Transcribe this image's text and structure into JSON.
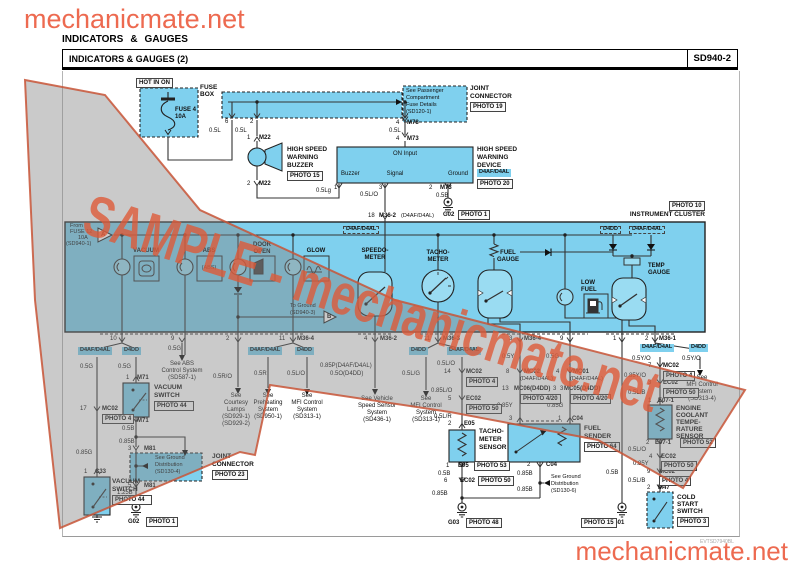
{
  "page": {
    "logo_top": "mechanicmate.net",
    "logo_bottom": "mechanicmate.net",
    "section_title": [
      "INDICATORS",
      "&",
      "GAUGES"
    ],
    "diagram_title": "INDICATORS & GAUGES (2)",
    "diagram_code": "SD940-2",
    "doc_code": "EVTSD7940BL",
    "watermark": "SAMPLE - mechanicmate.net"
  },
  "colors": {
    "accent_orange": "#ed6a50",
    "component_blue": "#7fd0ee",
    "watermark_gray": "rgba(128,128,128,0.42)",
    "watermark_orange": "#dd5a38",
    "wire": "#333333"
  },
  "texts": [
    [
      "FUSE 4",
      175,
      107,
      "xb"
    ],
    [
      "10A",
      175,
      114,
      "xb"
    ],
    [
      "FUSE",
      200,
      85,
      "sb"
    ],
    [
      "BOX",
      200,
      92,
      "sb"
    ],
    [
      "6",
      225,
      119,
      "x"
    ],
    [
      "2",
      250,
      119,
      "x"
    ],
    [
      "0.5L",
      209,
      128,
      "x"
    ],
    [
      "0.5L",
      235,
      128,
      "x"
    ],
    [
      "1",
      247,
      135,
      "x"
    ],
    [
      "M22",
      259,
      135,
      "xb"
    ],
    [
      "2",
      247,
      181,
      "x"
    ],
    [
      "M22",
      259,
      181,
      "xb"
    ],
    [
      "HIGH SPEED",
      287,
      147,
      "sb"
    ],
    [
      "WARNING",
      287,
      155,
      "sb"
    ],
    [
      "BUZZER",
      287,
      163,
      "sb"
    ],
    [
      "0.5Lg",
      316,
      188,
      "x"
    ],
    [
      "4",
      396,
      120,
      "x"
    ],
    [
      "M78",
      407,
      120,
      "xb"
    ],
    [
      "0.5L",
      389,
      128,
      "x"
    ],
    [
      "4",
      396,
      136,
      "x"
    ],
    [
      "M73",
      407,
      136,
      "xb"
    ],
    [
      "JOINT",
      470,
      86,
      "sb"
    ],
    [
      "CONNECTOR",
      470,
      94,
      "sb"
    ],
    [
      "See Passenger",
      406,
      89,
      "t"
    ],
    [
      "Compartment",
      406,
      96,
      "t"
    ],
    [
      "Fuse Details",
      406,
      103,
      "t"
    ],
    [
      "(SD120-1)",
      406,
      110,
      "t"
    ],
    [
      "ON Input",
      405,
      151,
      "x",
      "c"
    ],
    [
      "Buzzer",
      341,
      171,
      "x"
    ],
    [
      "Signal",
      395,
      171,
      "x",
      "c"
    ],
    [
      "Ground",
      468,
      171,
      "x",
      "r"
    ],
    [
      "1",
      334,
      185,
      "x"
    ],
    [
      "3",
      379,
      185,
      "x"
    ],
    [
      "0.5L/O",
      360,
      192,
      "x"
    ],
    [
      "2",
      429,
      185,
      "x"
    ],
    [
      "M73",
      440,
      185,
      "xb"
    ],
    [
      "0.5B",
      436,
      193,
      "x"
    ],
    [
      "HIGH SPEED",
      477,
      147,
      "sb"
    ],
    [
      "WARNING",
      477,
      155,
      "sb"
    ],
    [
      "DEVICE",
      477,
      163,
      "sb"
    ],
    [
      "G02",
      443,
      212,
      "xb"
    ],
    [
      "18",
      368,
      213,
      "x"
    ],
    [
      "M36-2",
      379,
      213,
      "xb"
    ],
    [
      "(D4AF/D4AL)",
      401,
      214,
      "t"
    ],
    [
      "INSTRUMENT CLUSTER",
      705,
      212,
      "sb",
      "r"
    ],
    [
      "From",
      70,
      224,
      "t"
    ],
    [
      "FUSE 12",
      70,
      230,
      "t"
    ],
    [
      "10A",
      78,
      236,
      "t"
    ],
    [
      "(SD940-1)",
      66,
      242,
      "t"
    ],
    [
      "A",
      101,
      232,
      "xb"
    ],
    [
      "B",
      327,
      314,
      "xb"
    ],
    [
      "VACUUM",
      146,
      248,
      "xb",
      "c"
    ],
    [
      "ABS",
      209,
      248,
      "xb",
      "c"
    ],
    [
      "DOOR",
      262,
      242,
      "xb",
      "c"
    ],
    [
      "OPEN",
      262,
      249,
      "xb",
      "c"
    ],
    [
      "GLOW",
      316,
      248,
      "xb",
      "c"
    ],
    [
      "(ABS)",
      209,
      266,
      "t",
      "c"
    ],
    [
      "To Ground",
      290,
      304,
      "t"
    ],
    [
      "(SD940-3)",
      290,
      311,
      "t"
    ],
    [
      "SPEEDO-",
      375,
      248,
      "xb",
      "c"
    ],
    [
      "METER",
      375,
      255,
      "xb",
      "c"
    ],
    [
      "TACHO-",
      438,
      250,
      "xb",
      "c"
    ],
    [
      "METER",
      438,
      257,
      "xb",
      "c"
    ],
    [
      "FUEL",
      508,
      250,
      "xb",
      "c"
    ],
    [
      "GAUGE",
      508,
      257,
      "xb",
      "c"
    ],
    [
      "LOW",
      581,
      280,
      "xb"
    ],
    [
      "FUEL",
      581,
      287,
      "xb"
    ],
    [
      "TEMP",
      648,
      263,
      "xb"
    ],
    [
      "GAUGE",
      648,
      270,
      "xb"
    ],
    [
      "10",
      110,
      336,
      "x"
    ],
    [
      "9",
      171,
      336,
      "x"
    ],
    [
      "2",
      226,
      336,
      "x"
    ],
    [
      "11",
      279,
      336,
      "x"
    ],
    [
      "M36-4",
      297,
      336,
      "xb"
    ],
    [
      "4",
      364,
      336,
      "x"
    ],
    [
      "M36-2",
      380,
      336,
      "xb"
    ],
    [
      "11",
      424,
      336,
      "x"
    ],
    [
      "M36-3",
      443,
      336,
      "xb"
    ],
    [
      "3",
      509,
      336,
      "x"
    ],
    [
      "M36-4",
      524,
      336,
      "xb"
    ],
    [
      "9",
      560,
      336,
      "x"
    ],
    [
      "1",
      613,
      336,
      "x"
    ],
    [
      "2",
      645,
      336,
      "x"
    ],
    [
      "M36-1",
      659,
      336,
      "xb"
    ],
    [
      "0.5G",
      80,
      364,
      "x"
    ],
    [
      "17",
      80,
      406,
      "x"
    ],
    [
      "MC02",
      102,
      406,
      "xb"
    ],
    [
      "0.85G",
      76,
      450,
      "x"
    ],
    [
      "1",
      84,
      469,
      "x"
    ],
    [
      "C33",
      95,
      469,
      "xb"
    ],
    [
      "VACUUM",
      112,
      479,
      "sb"
    ],
    [
      "SWITCH",
      112,
      487,
      "sb"
    ],
    [
      "0.5G",
      118,
      364,
      "x"
    ],
    [
      "1",
      126,
      375,
      "x"
    ],
    [
      "M71",
      137,
      375,
      "xb"
    ],
    [
      "VACUUM",
      154,
      385,
      "sb"
    ],
    [
      "SWITCH",
      154,
      393,
      "sb"
    ],
    [
      "2",
      126,
      418,
      "x"
    ],
    [
      "M71",
      137,
      418,
      "xb"
    ],
    [
      "0.5B",
      122,
      426,
      "x"
    ],
    [
      "0.85B",
      119,
      439,
      "x"
    ],
    [
      "3",
      128,
      446,
      "x"
    ],
    [
      "M81",
      144,
      446,
      "xb"
    ],
    [
      "See Ground",
      155,
      456,
      "t"
    ],
    [
      "Distribution",
      155,
      463,
      "t"
    ],
    [
      "(SD130-4)",
      155,
      470,
      "t"
    ],
    [
      "JOINT",
      212,
      454,
      "sb"
    ],
    [
      "CONNECTOR",
      212,
      462,
      "sb"
    ],
    [
      "5",
      128,
      483,
      "x"
    ],
    [
      "M81",
      144,
      483,
      "xb"
    ],
    [
      "1.25B",
      117,
      490,
      "x"
    ],
    [
      "1.25B",
      117,
      498,
      "x"
    ],
    [
      "G02",
      128,
      519,
      "xb"
    ],
    [
      "0.5G",
      168,
      346,
      "x"
    ],
    [
      "See ABS",
      182,
      361,
      "x",
      "c"
    ],
    [
      "Control System",
      182,
      368,
      "x",
      "c"
    ],
    [
      "(SD587-1)",
      182,
      375,
      "x",
      "c"
    ],
    [
      "0.5R/O",
      213,
      374,
      "x"
    ],
    [
      "See",
      236,
      393,
      "x",
      "c"
    ],
    [
      "Courtesy",
      236,
      400,
      "x",
      "c"
    ],
    [
      "Lamps",
      236,
      407,
      "x",
      "c"
    ],
    [
      "(SD929-1)",
      236,
      414,
      "x",
      "c"
    ],
    [
      "(SD929-2)",
      236,
      421,
      "x",
      "c"
    ],
    [
      "0.5R",
      254,
      371,
      "x"
    ],
    [
      "See",
      268,
      393,
      "x",
      "c"
    ],
    [
      "Preheating",
      268,
      400,
      "x",
      "c"
    ],
    [
      "System",
      268,
      407,
      "x",
      "c"
    ],
    [
      "(SD950-1)",
      268,
      414,
      "x",
      "c"
    ],
    [
      "0.5L/O",
      287,
      371,
      "x"
    ],
    [
      "See",
      307,
      393,
      "x",
      "c"
    ],
    [
      "MFI Control",
      307,
      400,
      "x",
      "c"
    ],
    [
      "System",
      307,
      407,
      "x",
      "c"
    ],
    [
      "(SD313-1)",
      307,
      414,
      "x",
      "c"
    ],
    [
      "0.85P(D4AF/D4AL)",
      320,
      363,
      "x"
    ],
    [
      "0.5O(D4DD)",
      330,
      371,
      "x"
    ],
    [
      "See Vehicle",
      377,
      396,
      "x",
      "c"
    ],
    [
      "Speed Sensor",
      377,
      403,
      "x",
      "c"
    ],
    [
      "System",
      377,
      410,
      "x",
      "c"
    ],
    [
      "(SD436-1)",
      377,
      417,
      "x",
      "c"
    ],
    [
      "0.5L/G",
      402,
      371,
      "x"
    ],
    [
      "See",
      426,
      396,
      "x",
      "c"
    ],
    [
      "MFI Control",
      426,
      403,
      "x",
      "c"
    ],
    [
      "System",
      426,
      410,
      "x",
      "c"
    ],
    [
      "(SD313-1)",
      426,
      417,
      "x",
      "c"
    ],
    [
      "0.5L/O",
      437,
      361,
      "x"
    ],
    [
      "14",
      444,
      369,
      "x"
    ],
    [
      "MC02",
      466,
      369,
      "xb"
    ],
    [
      "0.85L/O",
      431,
      388,
      "x"
    ],
    [
      "5",
      448,
      396,
      "x"
    ],
    [
      "EC02",
      466,
      396,
      "xb"
    ],
    [
      "0.5L/R",
      434,
      414,
      "x"
    ],
    [
      "2",
      448,
      421,
      "x"
    ],
    [
      "E05",
      464,
      421,
      "xb"
    ],
    [
      "TACHO-",
      479,
      429,
      "sb"
    ],
    [
      "METER",
      479,
      437,
      "sb"
    ],
    [
      "SENSOR",
      479,
      445,
      "sb"
    ],
    [
      "1",
      446,
      463,
      "x"
    ],
    [
      "E05",
      458,
      463,
      "xb"
    ],
    [
      "0.5B",
      438,
      471,
      "x"
    ],
    [
      "6",
      444,
      478,
      "x"
    ],
    [
      "EC02",
      460,
      478,
      "xb"
    ],
    [
      "0.85B",
      432,
      491,
      "x"
    ],
    [
      "G03",
      448,
      520,
      "xb"
    ],
    [
      "0.5Y",
      502,
      354,
      "x"
    ],
    [
      "8",
      506,
      369,
      "x"
    ],
    [
      "MC02",
      524,
      369,
      "xb"
    ],
    [
      "(D4AF/D4AL)",
      520,
      377,
      "t"
    ],
    [
      "13",
      502,
      386,
      "x"
    ],
    [
      "MC06(D4DD)",
      514,
      386,
      "xb"
    ],
    [
      "3",
      560,
      386,
      "x"
    ],
    [
      "0.85Y",
      497,
      403,
      "x"
    ],
    [
      "3",
      509,
      416,
      "x"
    ],
    [
      "0.5G",
      546,
      354,
      "x"
    ],
    [
      "4",
      556,
      369,
      "x"
    ],
    [
      "MC01",
      573,
      369,
      "xb"
    ],
    [
      "(D4AF/D4AL)",
      570,
      377,
      "t"
    ],
    [
      "3",
      553,
      386,
      "x"
    ],
    [
      "MC05(D4DD)",
      564,
      386,
      "xb"
    ],
    [
      "0.85G",
      547,
      403,
      "x"
    ],
    [
      "1",
      558,
      416,
      "x"
    ],
    [
      "C04",
      572,
      416,
      "xb"
    ],
    [
      "FUEL",
      584,
      426,
      "sb"
    ],
    [
      "SENDER",
      584,
      434,
      "sb"
    ],
    [
      "2",
      527,
      462,
      "x"
    ],
    [
      "C04",
      546,
      462,
      "xb"
    ],
    [
      "0.85B",
      517,
      471,
      "x"
    ],
    [
      "See Ground",
      551,
      475,
      "t"
    ],
    [
      "Distribution",
      551,
      482,
      "t"
    ],
    [
      "(SD130-6)",
      551,
      489,
      "t"
    ],
    [
      "0.85B",
      517,
      487,
      "x"
    ],
    [
      "0.5B",
      606,
      470,
      "x"
    ],
    [
      "G01",
      613,
      520,
      "xb"
    ],
    [
      "0.5Y/O",
      632,
      356,
      "x"
    ],
    [
      "0.5Y/O",
      682,
      356,
      "x"
    ],
    [
      "See",
      702,
      375,
      "x",
      "c"
    ],
    [
      "MFI Control",
      702,
      382,
      "x",
      "c"
    ],
    [
      "System",
      702,
      389,
      "x",
      "c"
    ],
    [
      "(SD313-4)",
      702,
      396,
      "x",
      "c"
    ],
    [
      "7",
      648,
      363,
      "x"
    ],
    [
      "MC02",
      663,
      363,
      "xb"
    ],
    [
      "0.85Y/O",
      624,
      373,
      "x"
    ],
    [
      "3",
      648,
      380,
      "x"
    ],
    [
      "EC02",
      663,
      380,
      "xb"
    ],
    [
      "0.5L/B",
      628,
      390,
      "x"
    ],
    [
      "1",
      648,
      398,
      "x"
    ],
    [
      "E07-1",
      658,
      398,
      "xb"
    ],
    [
      "ENGINE",
      676,
      406,
      "sb"
    ],
    [
      "COOLANT",
      676,
      413,
      "sb"
    ],
    [
      "TEMPE-",
      676,
      420,
      "sb"
    ],
    [
      "RATURE",
      676,
      427,
      "sb"
    ],
    [
      "SENSOR",
      676,
      434,
      "sb"
    ],
    [
      "2",
      646,
      440,
      "x"
    ],
    [
      "E07-1",
      655,
      440,
      "xb"
    ],
    [
      "0.5L/O",
      628,
      447,
      "x"
    ],
    [
      "4",
      649,
      454,
      "x"
    ],
    [
      "EC02",
      661,
      454,
      "xb"
    ],
    [
      "0.85Y",
      633,
      461,
      "x"
    ],
    [
      "9",
      647,
      469,
      "x"
    ],
    [
      "MC02",
      659,
      469,
      "xb"
    ],
    [
      "0.5L/B",
      628,
      478,
      "x"
    ],
    [
      "2",
      647,
      485,
      "x"
    ],
    [
      "M47",
      658,
      485,
      "xb"
    ],
    [
      "COLD",
      677,
      495,
      "sb"
    ],
    [
      "START",
      677,
      502,
      "sb"
    ],
    [
      "SWITCH",
      677,
      509,
      "sb"
    ]
  ],
  "chips": [
    [
      "D4AF/D4AL",
      78,
      347
    ],
    [
      "D4DD",
      122,
      347
    ],
    [
      "D4AF/D4AL",
      248,
      347
    ],
    [
      "D4DD",
      295,
      347
    ],
    [
      "D4DD",
      409,
      347
    ],
    [
      "D4AF/D4AL",
      447,
      347
    ],
    [
      "D4AF/D4AL",
      640,
      344
    ],
    [
      "D4DD",
      689,
      344
    ],
    [
      "D4AF/D4AL",
      477,
      169
    ],
    [
      "D4DD",
      600,
      226,
      1
    ],
    [
      "D4AF/D4AL",
      629,
      226,
      1
    ],
    [
      "D4AF/D4AL",
      343,
      226,
      1
    ]
  ],
  "photos": [
    [
      "HOT IN ON",
      136,
      78
    ],
    [
      "PHOTO 15",
      287,
      171
    ],
    [
      "PHOTO 19",
      470,
      102
    ],
    [
      "PHOTO 20",
      477,
      179
    ],
    [
      "PHOTO 1",
      458,
      210
    ],
    [
      "PHOTO 10",
      669,
      201
    ],
    [
      "PHOTO 4",
      102,
      414
    ],
    [
      "PHOTO 44",
      112,
      495,
      34
    ],
    [
      "PHOTO 44",
      154,
      401,
      34
    ],
    [
      "PHOTO 23",
      212,
      470
    ],
    [
      "PHOTO 1",
      146,
      517
    ],
    [
      "PHOTO 4",
      466,
      377
    ],
    [
      "PHOTO 50",
      466,
      404
    ],
    [
      "PHOTO 53",
      474,
      461
    ],
    [
      "PHOTO 50",
      478,
      476
    ],
    [
      "PHOTO 48",
      466,
      518
    ],
    [
      "PHOTO 4/20",
      520,
      394
    ],
    [
      "PHOTO 4/20",
      570,
      394
    ],
    [
      "PHOTO 64",
      584,
      442,
      30
    ],
    [
      "PHOTO 15",
      581,
      518
    ],
    [
      "PHOTO 4",
      663,
      371
    ],
    [
      "PHOTO 50",
      663,
      388
    ],
    [
      "PHOTO 52",
      680,
      438
    ],
    [
      "PHOTO 50",
      661,
      461
    ],
    [
      "PHOTO 4",
      659,
      476
    ],
    [
      "PHOTO 3",
      677,
      517
    ]
  ]
}
